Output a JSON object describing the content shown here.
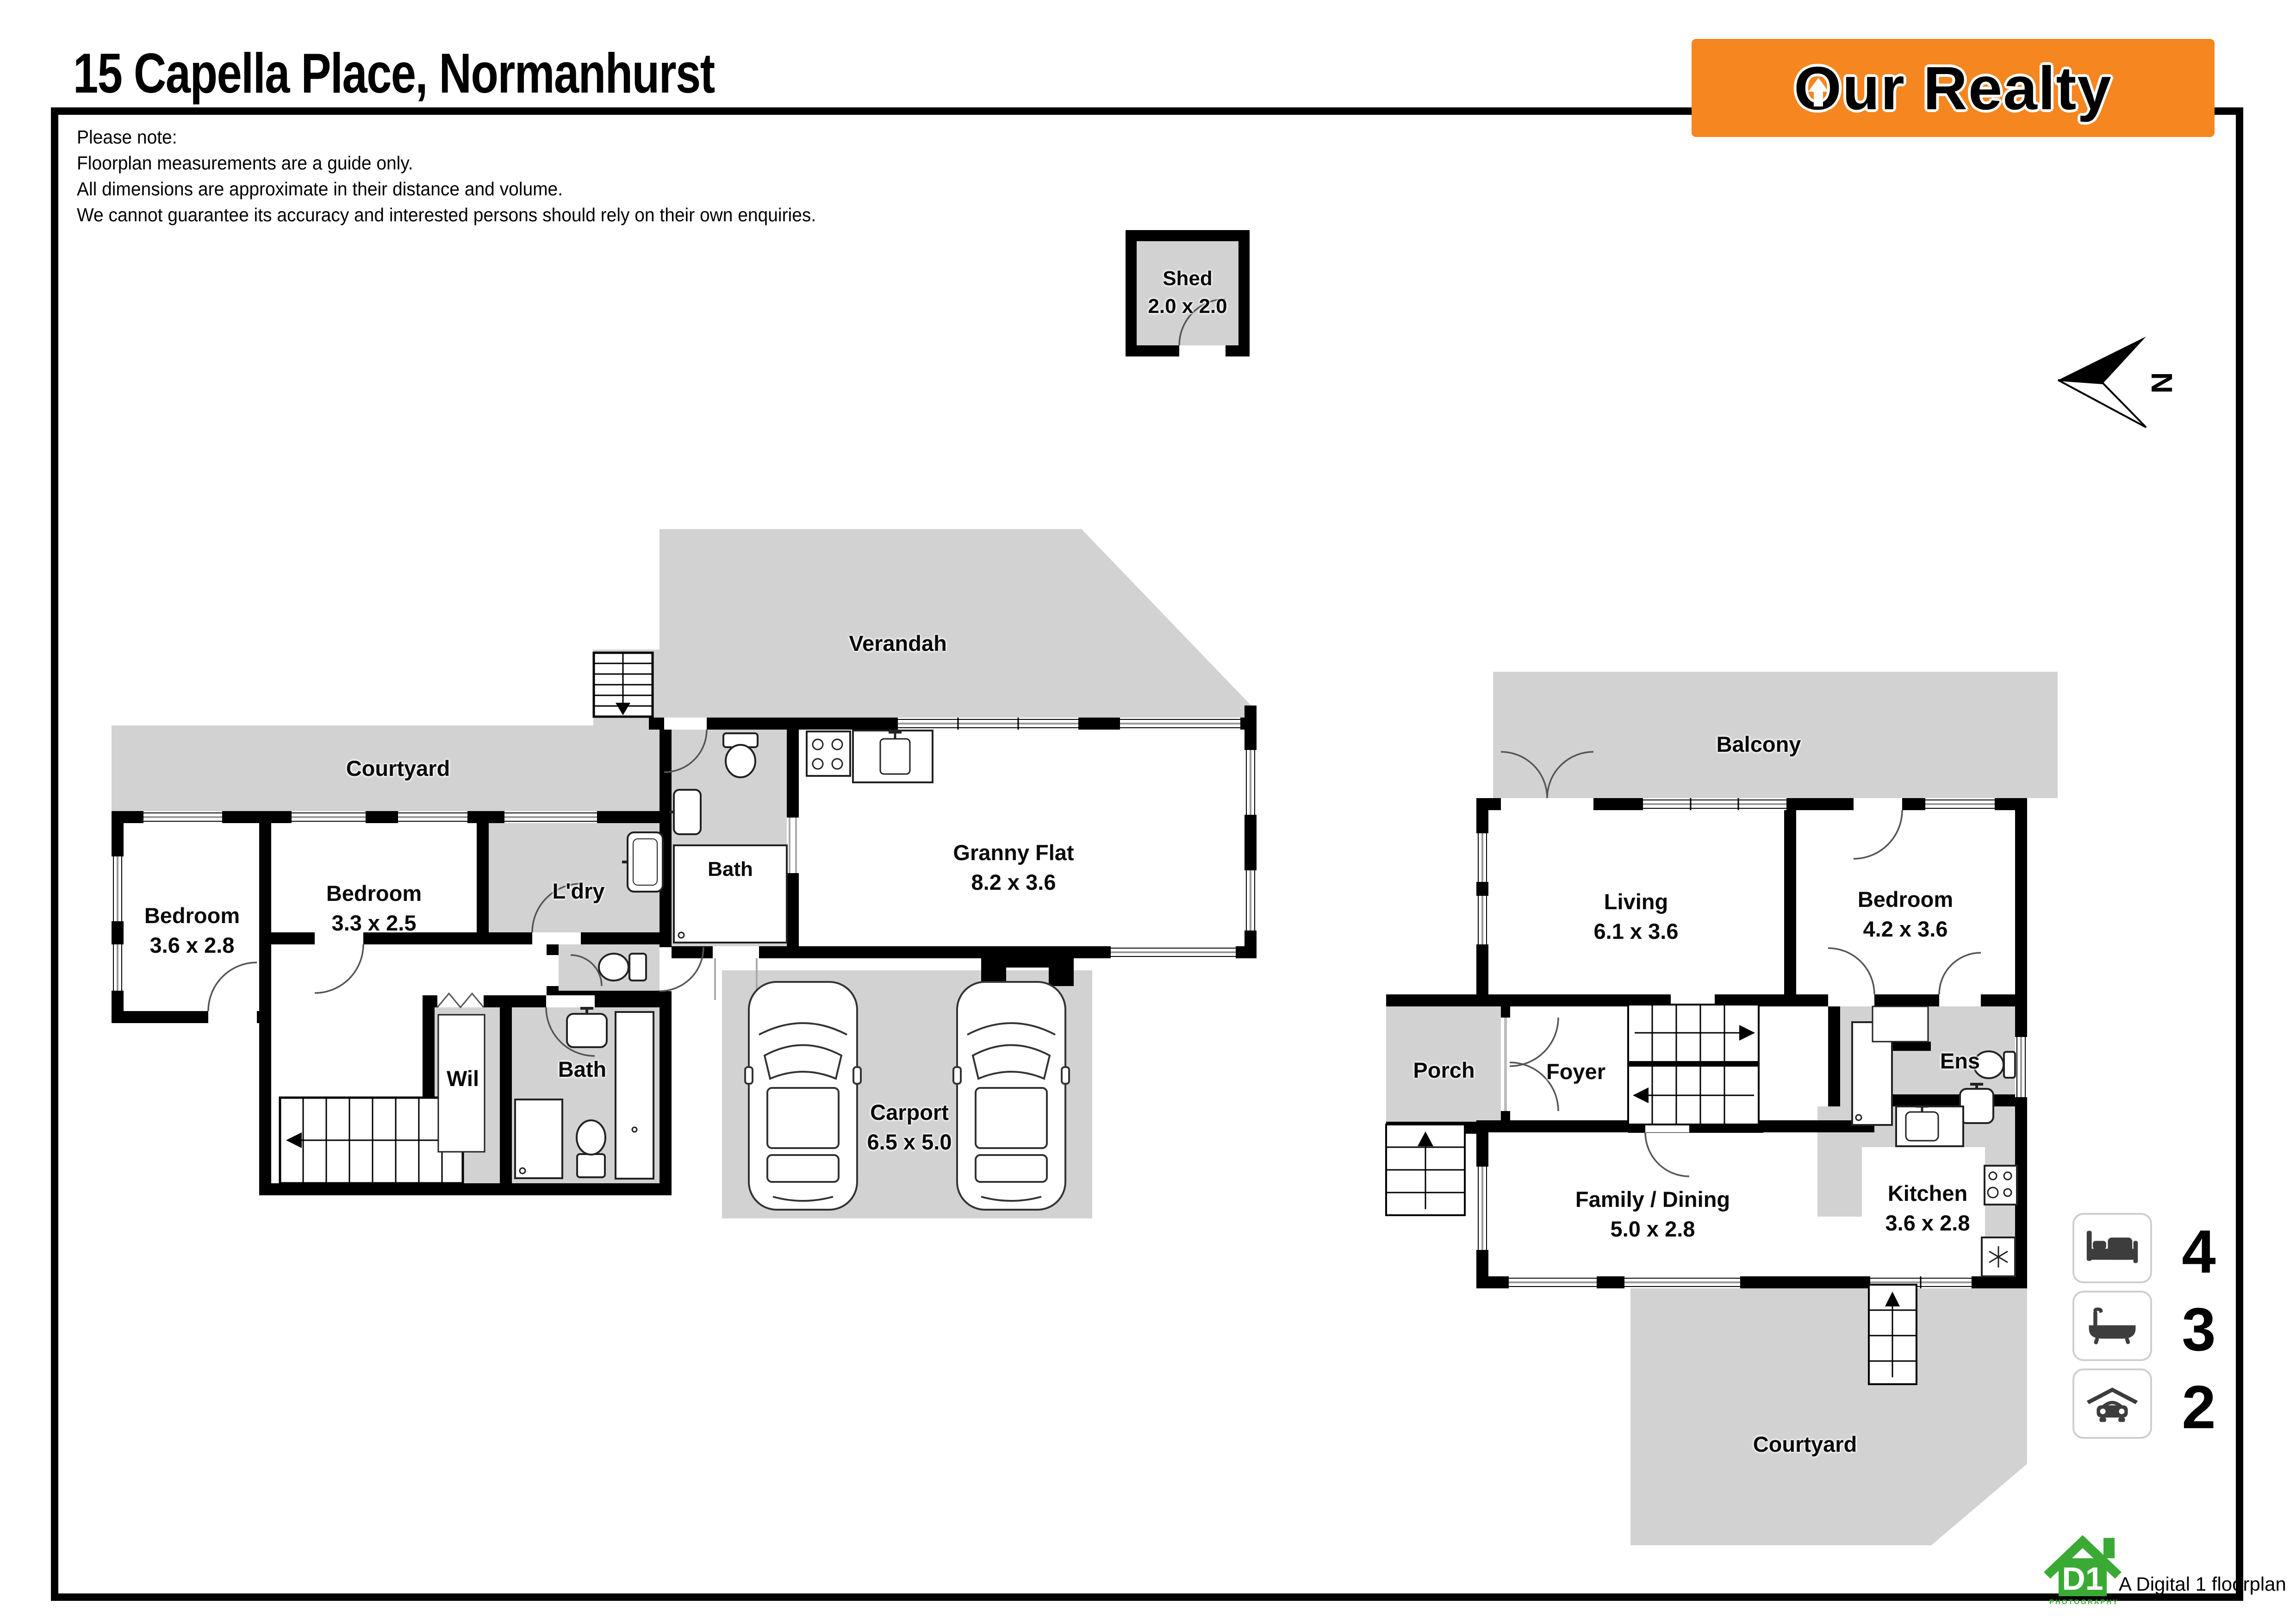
{
  "title": "15 Capella Place, Normanhurst",
  "disclaimer": {
    "lines": [
      "Please note:",
      "Floorplan measurements are a guide only.",
      "All dimensions are approximate in their distance and volume.",
      "We cannot guarantee its accuracy and interested persons should rely on their own enquiries."
    ]
  },
  "brand": {
    "first_letter": "O",
    "rest": "ur Realty",
    "accent": "#F6861F"
  },
  "compass": {
    "label": "N"
  },
  "shed": {
    "name": "Shed",
    "dims": "2.0 x 2.0"
  },
  "plans": {
    "left": {
      "verandah": {
        "name": "Verandah"
      },
      "courtyard": {
        "name": "Courtyard"
      },
      "bedroom1": {
        "name": "Bedroom",
        "dims": "3.6 x 2.8"
      },
      "bedroom2": {
        "name": "Bedroom",
        "dims": "3.3 x 2.5"
      },
      "laundry": {
        "name": "L'dry"
      },
      "granny_bath": {
        "name": "Bath"
      },
      "granny_flat": {
        "name": "Granny Flat",
        "dims": "8.2 x 3.6"
      },
      "wil": {
        "name": "Wil"
      },
      "bath": {
        "name": "Bath"
      },
      "carport": {
        "name": "Carport",
        "dims": "6.5 x 5.0"
      }
    },
    "right": {
      "balcony": {
        "name": "Balcony"
      },
      "living": {
        "name": "Living",
        "dims": "6.1 x 3.6"
      },
      "bedroom": {
        "name": "Bedroom",
        "dims": "4.2 x 3.6"
      },
      "porch": {
        "name": "Porch"
      },
      "foyer": {
        "name": "Foyer"
      },
      "ens": {
        "name": "Ens"
      },
      "family_dining": {
        "name": "Family / Dining",
        "dims": "5.0 x 2.8"
      },
      "kitchen": {
        "name": "Kitchen",
        "dims": "3.6 x 2.8"
      },
      "courtyard": {
        "name": "Courtyard"
      }
    }
  },
  "legend": {
    "items": [
      {
        "name": "bedrooms",
        "icon": "bed-icon",
        "count": "4"
      },
      {
        "name": "bathrooms",
        "icon": "bath-icon",
        "count": "3"
      },
      {
        "name": "car-spaces",
        "icon": "car-icon",
        "count": "2"
      }
    ]
  },
  "footer": {
    "badge_text": "D1",
    "badge_sub": "PHOTOGRAPHY",
    "tagline": "A Digital 1 floorplan"
  },
  "colors": {
    "brand_orange": "#F6861F",
    "floor_gray": "#D2D2D2",
    "logo_green": "#3AAA35",
    "wall_black": "#000000"
  }
}
